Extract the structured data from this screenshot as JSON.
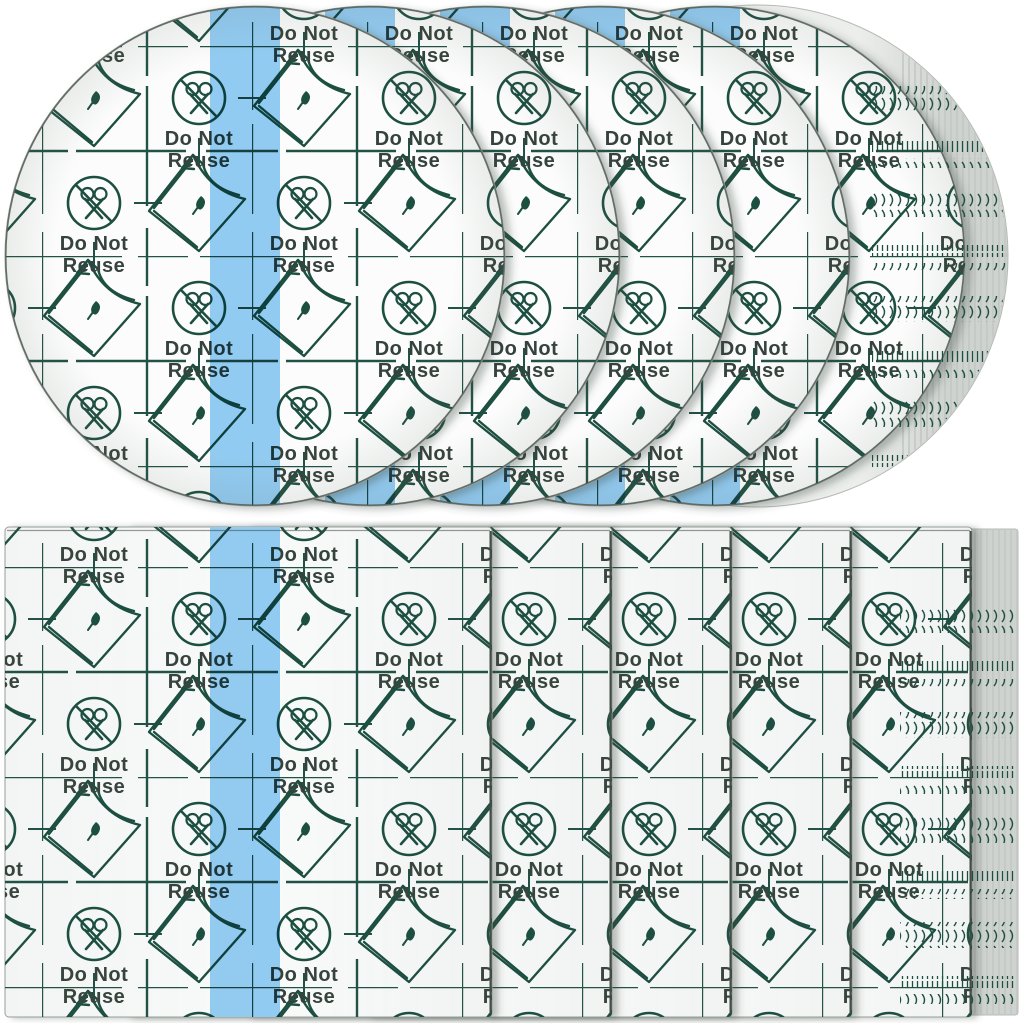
{
  "image": {
    "type": "product-photo",
    "subject": "Stacks of transparent waterproof adhesive film dressings: five round films above five rectangular sheets, each printed with a grid, peel-corner icons, no-scissors icons and a blue stripe",
    "label": {
      "line1": "Do Not",
      "line2": "Reuse"
    },
    "counts": {
      "round_films": 5,
      "rectangular_films": 5
    },
    "icons": [
      "no-scissors-icon",
      "peel-corner-film-icon"
    ],
    "colors": {
      "background": "#ffffff",
      "film_bg": "#fbfcfb",
      "sheet_bg": "#f9fbfa",
      "grid_green": "#215144",
      "icon_green": "#1d4f41",
      "text_color": "#36433c",
      "stripe_blue": "#92cbf1",
      "stack_gray": "#cfd3d0",
      "stack_gray_light": "#eceeec",
      "stack_line": "#c3c7c4",
      "edge_dark": "#434e47",
      "edge_mid": "#97a19a"
    }
  }
}
